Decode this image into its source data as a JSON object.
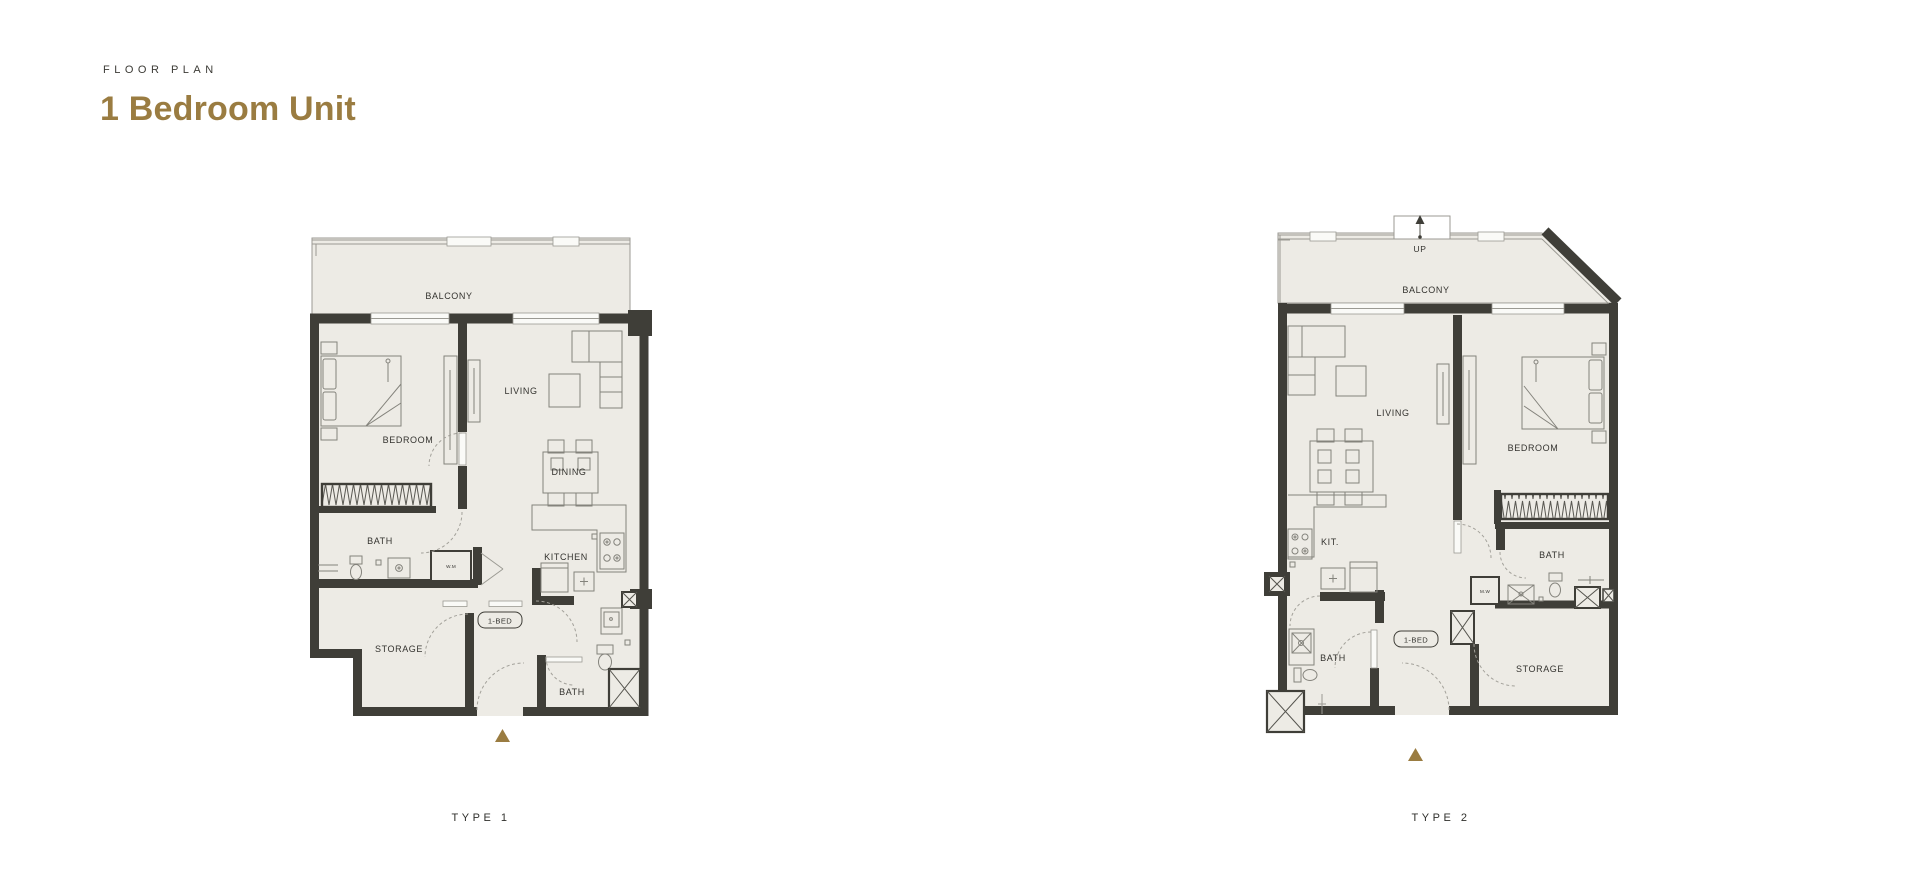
{
  "header": {
    "eyebrow": "FLOOR PLAN",
    "title": "1 Bedroom Unit"
  },
  "plan1": {
    "label": "TYPE 1",
    "tag": "1-BED",
    "rooms": {
      "balcony": "BALCONY",
      "bedroom": "BEDROOM",
      "living": "LIVING",
      "dining": "DINING",
      "kitchen": "KITCHEN",
      "bath1": "BATH",
      "bath2": "BATH",
      "storage": "STORAGE",
      "wm": "W.M"
    }
  },
  "plan2": {
    "label": "TYPE 2",
    "tag": "1-BED",
    "stair": "UP",
    "rooms": {
      "balcony": "BALCONY",
      "living": "LIVING",
      "bedroom": "BEDROOM",
      "kitchen": "KIT.",
      "bath1": "BATH",
      "bath2": "BATH",
      "storage": "STORAGE",
      "mw": "M.W"
    }
  },
  "colors": {
    "accent": "#9a7c41",
    "wall": "#3f3e38",
    "floor": "#edebe5"
  }
}
